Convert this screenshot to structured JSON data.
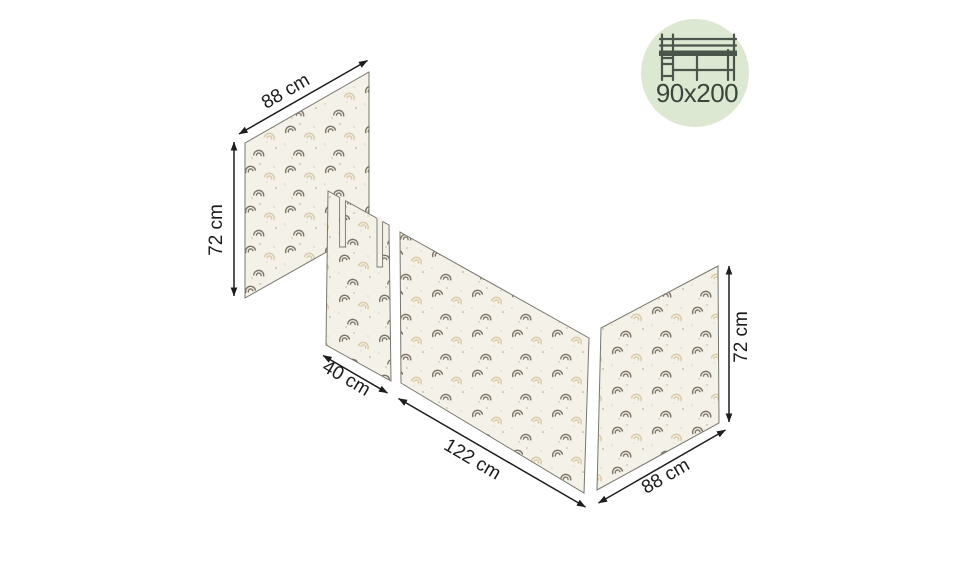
{
  "badge": {
    "size_label": "90x200",
    "icon": "loft-bed-icon",
    "bg_color": "#dde8d2",
    "icon_color": "#4a564b",
    "text_color": "#3b463b"
  },
  "diagram": {
    "type": "product-dimension-diagram",
    "subject": "bed-curtain-panels",
    "panels": [
      {
        "id": "left-side-panel",
        "width": "88 cm",
        "height": "72 cm",
        "pattern": "rainbow-print"
      },
      {
        "id": "front-left-panel",
        "width": "40 cm",
        "pattern": "rainbow-print",
        "slits": 2
      },
      {
        "id": "front-main-panel",
        "width": "122 cm",
        "pattern": "rainbow-print"
      },
      {
        "id": "right-side-panel",
        "width": "88 cm",
        "height": "72 cm",
        "pattern": "rainbow-print"
      }
    ],
    "colors": {
      "fabric": "#f4f1e8",
      "outline": "#77776e",
      "dimension_lines": "#1d1d1d",
      "motif_dark": "#7d7468",
      "motif_light": "#d8c9a6"
    }
  }
}
